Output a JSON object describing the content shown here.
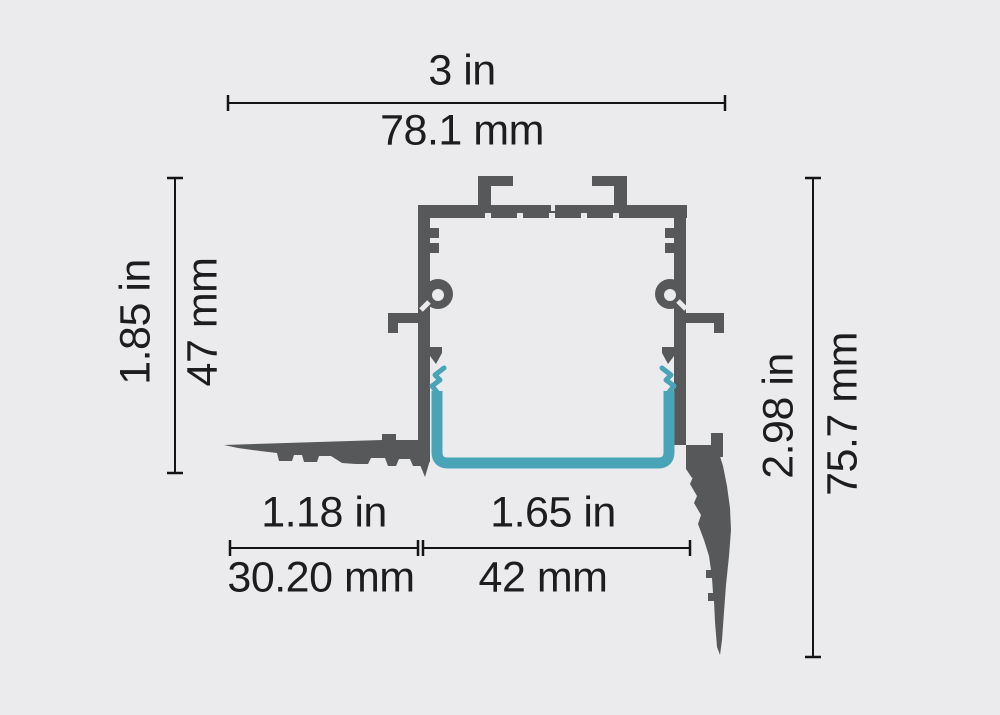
{
  "canvas": {
    "width": 1000,
    "height": 715,
    "background": "#ebebee"
  },
  "colors": {
    "profile": "#57585a",
    "channel": "#4aa4b8",
    "dimension_lines": "#141414",
    "text": "#1d1d1f"
  },
  "dimensions": {
    "top": {
      "label_in": "3 in",
      "label_mm": "78.1 mm"
    },
    "left": {
      "label_in": "1.85 in",
      "label_mm": "47 mm"
    },
    "right": {
      "label_in": "2.98 in",
      "label_mm": "75.7 mm"
    },
    "bottom_left": {
      "label_in": "1.18 in",
      "label_mm": "30.20 mm"
    },
    "bottom_right": {
      "label_in": "1.65 in",
      "label_mm": "42 mm"
    }
  }
}
